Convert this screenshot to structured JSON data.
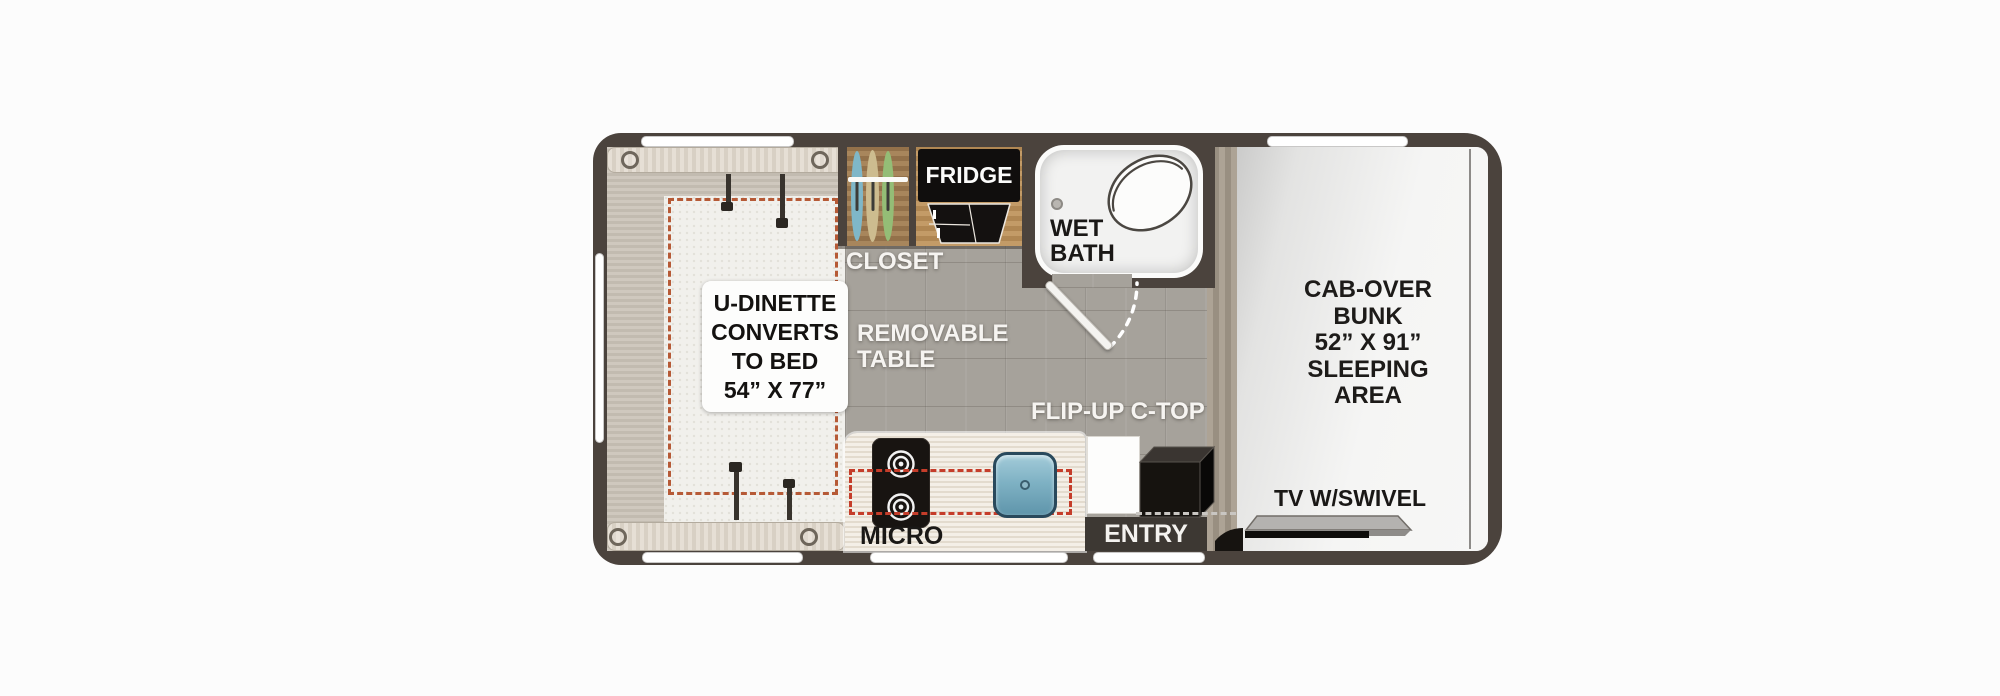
{
  "floorplan": {
    "areas": {
      "dinette": {
        "lines": [
          "U-DINETTE",
          "CONVERTS",
          "TO BED",
          "54” X 77”"
        ]
      },
      "closet": {
        "label": "CLOSET"
      },
      "fridge": {
        "label": "FRIDGE"
      },
      "wet_bath": {
        "lines": [
          "WET",
          "BATH"
        ]
      },
      "removable_table": {
        "lines": [
          "REMOVABLE",
          "TABLE"
        ]
      },
      "flip_up_ctop": {
        "label": "FLIP-UP C-TOP"
      },
      "micro": {
        "label": "MICRO"
      },
      "entry": {
        "label": "ENTRY"
      },
      "tv": {
        "label": "TV W/SWIVEL"
      },
      "cab_over_bunk": {
        "lines": [
          "CAB-OVER",
          "BUNK",
          "52” X 91”",
          "SLEEPING",
          "AREA"
        ]
      }
    },
    "colors": {
      "wall": "#4b433d",
      "tile_floor": "#a6a29b",
      "dinette_bed": "#f1f0ec",
      "bench_wood": "#ded7cc",
      "counter": "#ece5d9",
      "closet_wood": "#9c7c52",
      "bunk_floor": "#ededec",
      "bed_outline_dash": "#b65a36",
      "counter_outline_dash": "#c53d2a",
      "sink_blue": "#7fb2c4"
    },
    "icons": {
      "cooktop": "two-burner-rings",
      "sink": "square-basin-with-drain",
      "toilet": "tilted-oval",
      "clothes_colors": [
        "#7fb7c8",
        "#cdbc8f",
        "#94bd76"
      ],
      "tv": "swivel-bar",
      "entry_step": "black-box"
    }
  }
}
